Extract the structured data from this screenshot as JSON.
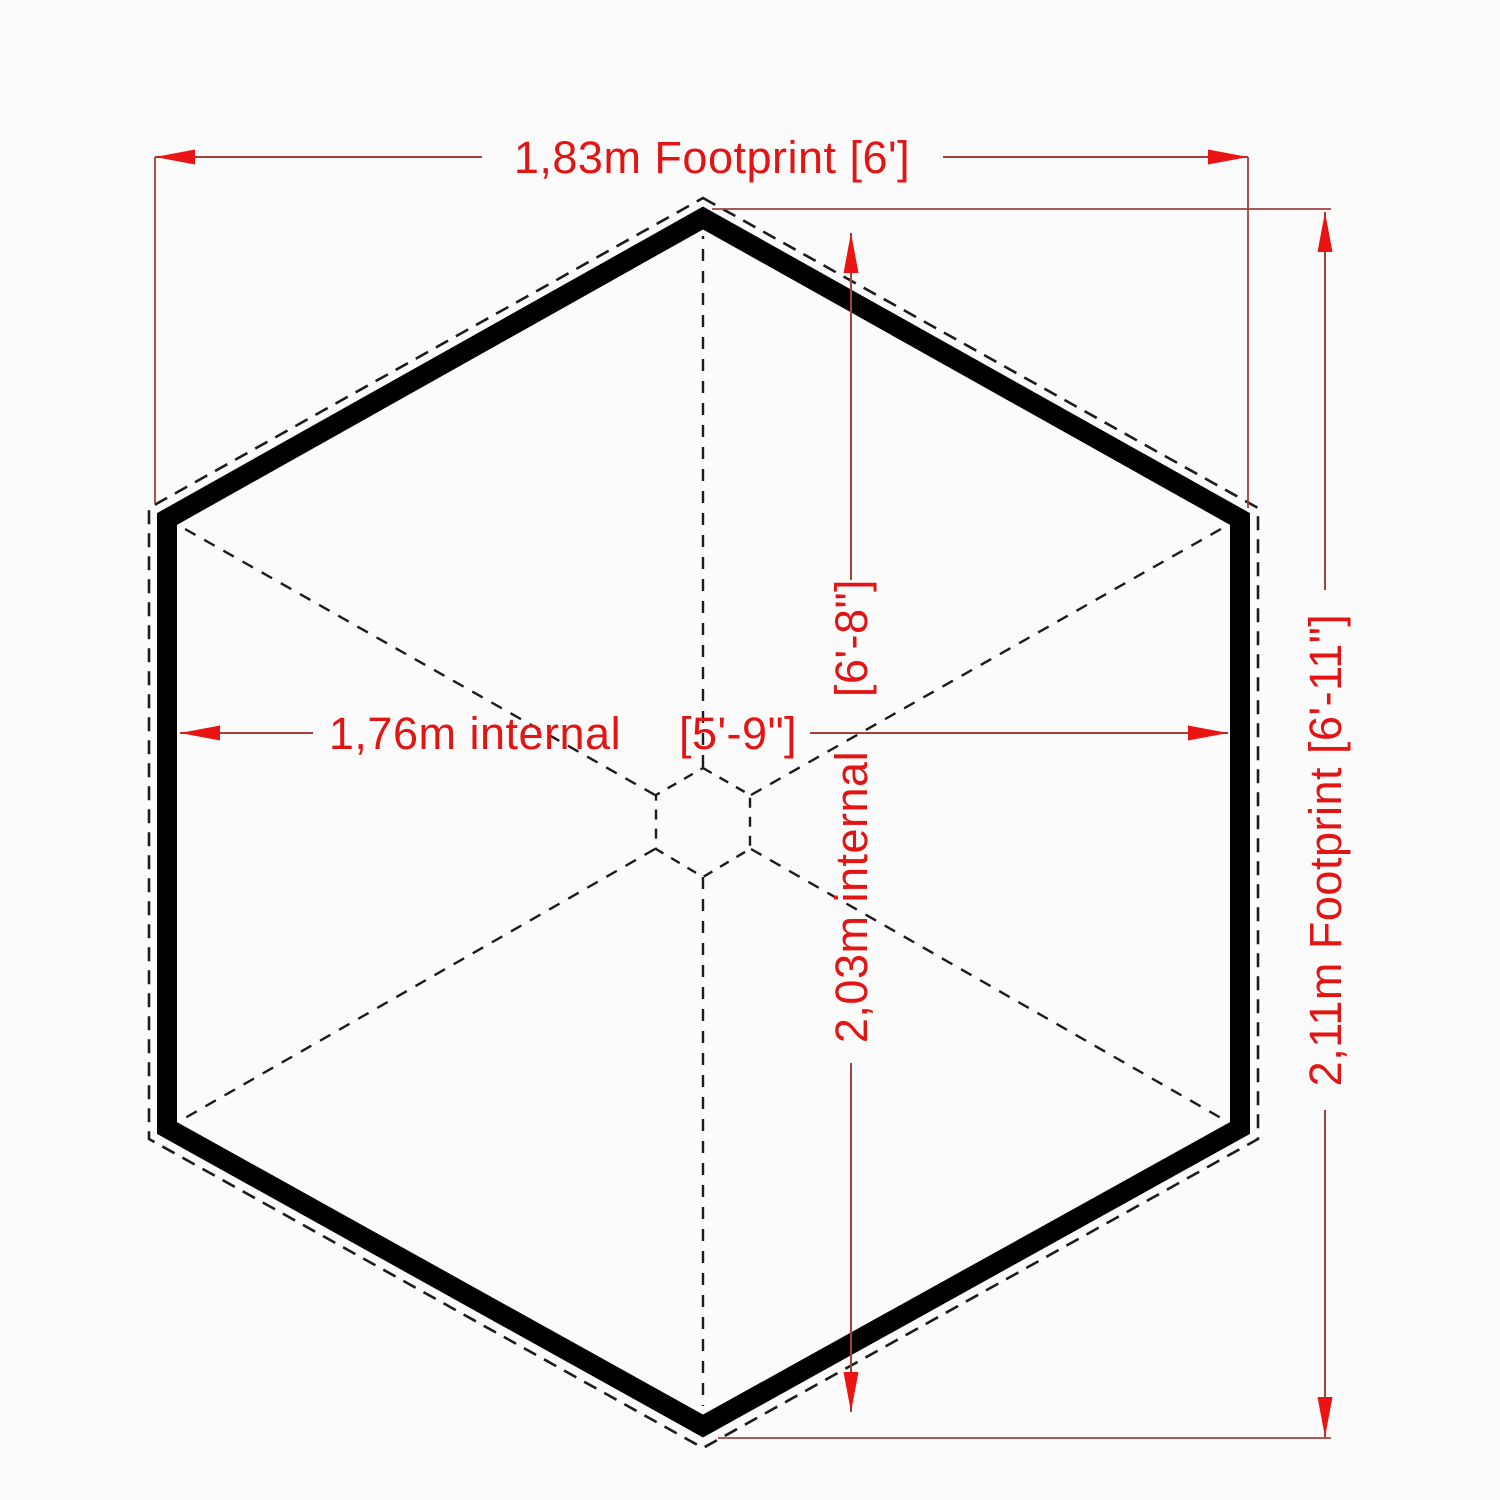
{
  "diagram": {
    "description_colors": {
      "background": "#fbfbfb",
      "wall": "#000000",
      "dashed_line": "#1b1b1b",
      "dimension_line": "#9e423b",
      "dimension_text": "#e31414",
      "arrowhead": "#ea1414"
    }
  },
  "dimensions": {
    "footprint_width": {
      "label": "1,83m Footprint [6']"
    },
    "footprint_height": {
      "label": "2,11m Footprint [6'-11\"]"
    },
    "internal_width": {
      "metric_label": "1,76m internal",
      "imperial_label": "[5'-9\"]"
    },
    "internal_height": {
      "metric_label": "2,03m internal",
      "imperial_label": "[6'-8\"]"
    }
  }
}
